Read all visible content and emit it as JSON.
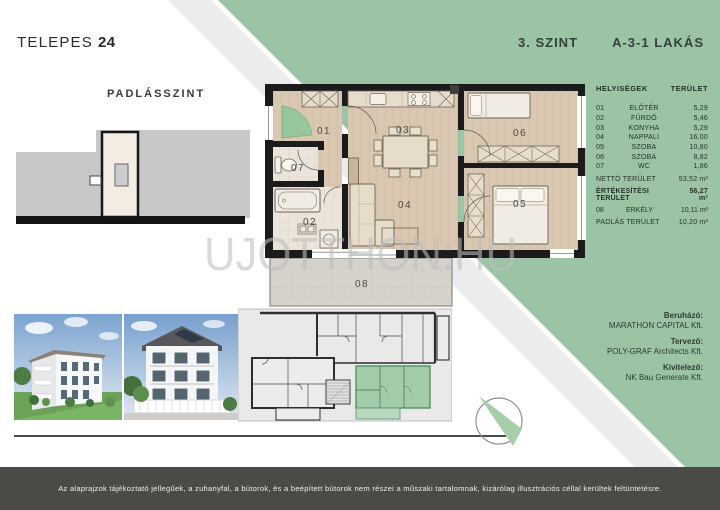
{
  "brand": {
    "name": "TELEPES",
    "number": "24"
  },
  "header": {
    "floor": "3. SZINT",
    "unit": "A-3-1 LAKÁS"
  },
  "attic_label": "PADLÁSSZINT",
  "area_table": {
    "header": {
      "rooms": "HELYISÉGEK",
      "area": "TERÜLET"
    },
    "rows": [
      {
        "num": "01",
        "name": "ELŐTÉR",
        "area": "5,29"
      },
      {
        "num": "02",
        "name": "FÜRDŐ",
        "area": "5,46"
      },
      {
        "num": "03",
        "name": "KONYHA",
        "area": "5,29"
      },
      {
        "num": "04",
        "name": "NAPPALI",
        "area": "16,00"
      },
      {
        "num": "05",
        "name": "SZOBA",
        "area": "10,80"
      },
      {
        "num": "06",
        "name": "SZOBA",
        "area": "8,82"
      },
      {
        "num": "07",
        "name": "WC",
        "area": "1,86"
      }
    ],
    "net": {
      "label": "NETTÓ TERÜLET",
      "value": "53,52 m²"
    },
    "sales": {
      "label": "ÉRTÉKESÍTÉSI TERÜLET",
      "value": "56,27 m²"
    },
    "balcony": {
      "num": "08",
      "name": "ERKÉLY",
      "area": "10,11 m²"
    },
    "attic": {
      "label": "PADLÁS TERÜLET",
      "value": "10,20 m²"
    }
  },
  "floor_plan": {
    "labels": {
      "r01": "01",
      "r02": "02",
      "r03": "03",
      "r04": "04",
      "r05": "05",
      "r06": "06",
      "r07": "07",
      "r08": "08"
    }
  },
  "credits": {
    "developer": {
      "role": "Beruházó:",
      "company": "MARATHON CAPITAL Kft."
    },
    "architect": {
      "role": "Tervező:",
      "company": "POLY-GRAF Architects Kft."
    },
    "contractor": {
      "role": "Kivitelező:",
      "company": "NK Bau Generate Kft."
    }
  },
  "watermark": "UJOTTHON:HU",
  "disclaimer": "Az alaprajzok tájékoztató jellegűek, a zuhanyfal, a bútorok, és a beépített bútorok nem részei a műszaki tartalomnak, kizárólag illusztrációs céllal kerültek feltüntetésre.",
  "colors": {
    "accent_green": "#9cc4a4",
    "stripe_gray": "#ececec",
    "footer_bar": "#4a4a47",
    "plan_floor": "#d9c7b1",
    "plan_wall": "#1b1b1b",
    "highlight_unit": "#98c8a1"
  }
}
